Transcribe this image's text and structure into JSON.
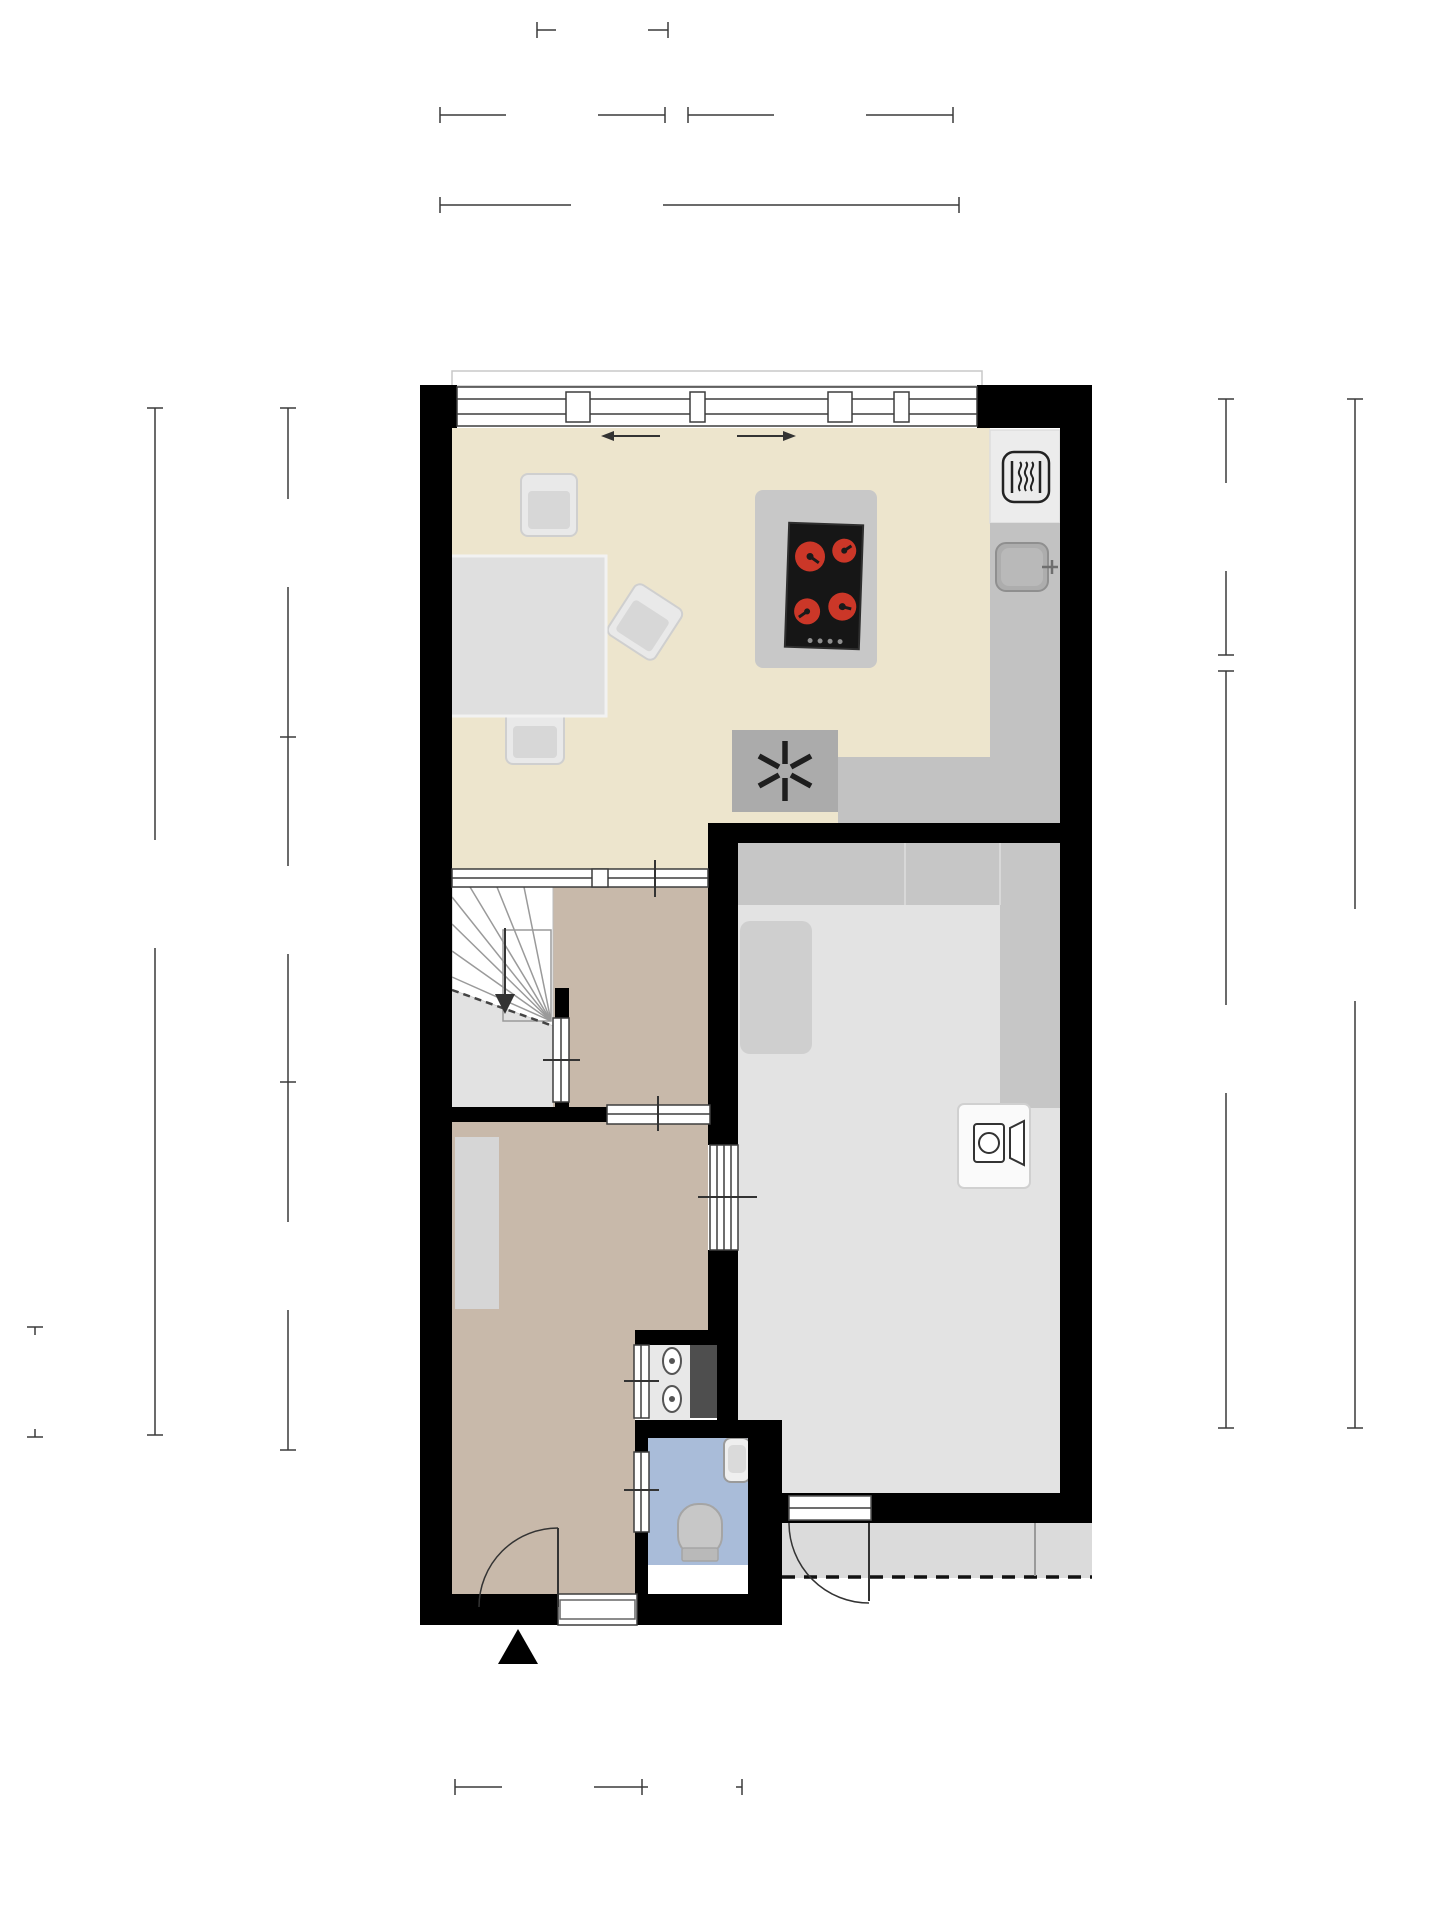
{
  "rooms": {
    "keuken": "Keuken",
    "hal": "Hal",
    "kast": "Kast",
    "entree": "Entree",
    "berging": "Berging",
    "overkapping": "Overkapping"
  },
  "dimensions": {
    "top": [
      "1.35 m",
      "2.33 m",
      "2.75 m",
      "5.38 m"
    ],
    "left": [
      "3.95 m",
      "1.99 m",
      "4.35 m",
      "10.34 m",
      "1.33 m"
    ],
    "right": [
      "3.51 m",
      "5.76 m",
      "9.47 m"
    ],
    "bottom": [
      "1.62 m",
      "0.91 m"
    ]
  },
  "disclaimer": [
    "Deze plattegronden zijn opgemaakt voor indicatieve doeleinden.",
    "Hieraan kunnen geen rechten worden ontleend."
  ],
  "icons": {
    "stove": "four-red-burners",
    "oven": "heat-waves-square",
    "sink": "basin-with-tap",
    "extractor_fan": "asterisk",
    "washing_machine": "drum-and-door",
    "toilet": "wc-bowl",
    "hand_basin": "small-basin",
    "meters": "utility-meters",
    "entrance": "black-arrow-triangle"
  },
  "colors": {
    "wall": "#000000",
    "keuken_floor": "#EDE5CD",
    "hal_floor": "#C8B9AA",
    "kast_floor": "#E2E2E2",
    "berging_floor": "#E3E3E3",
    "toilet_floor": "#A9BCD9",
    "overkapping_floor": "#DBDBDB",
    "counter": "#C2C2C2",
    "burner_red": "#CB3728"
  }
}
